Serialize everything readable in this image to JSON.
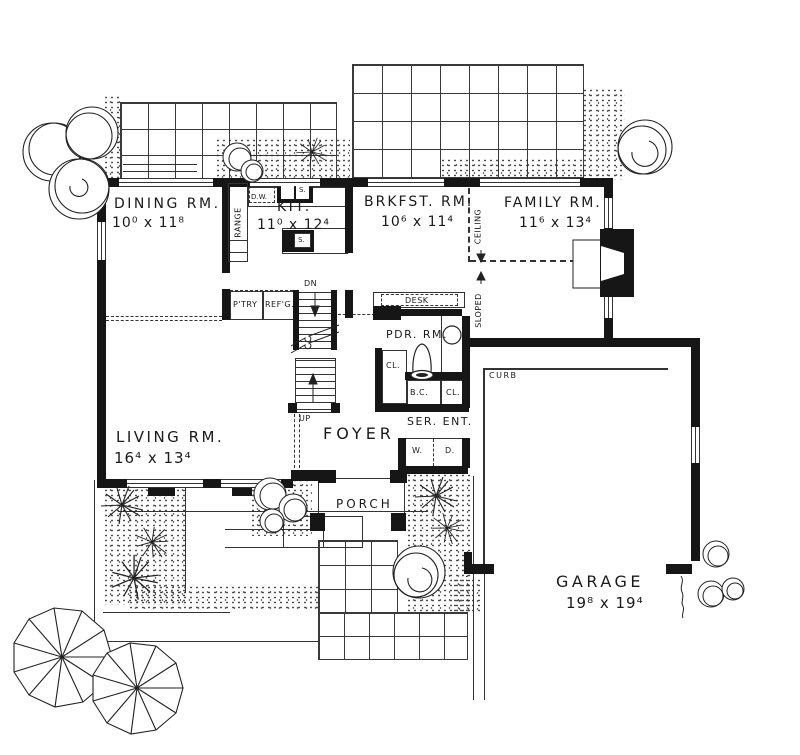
{
  "drawing": {
    "type": "house floor plan",
    "ink": "#1a1a1a",
    "paper": "#ffffff"
  },
  "rooms": {
    "dining": {
      "name": "DINING RM.",
      "dims": "10⁰ x 11⁸"
    },
    "kitchen": {
      "name": "KIT.",
      "dims": "11⁰ x 12⁴"
    },
    "breakfast": {
      "name": "BRKFST. RM.",
      "dims": "10⁶ x 11⁴"
    },
    "family": {
      "name": "FAMILY RM.",
      "dims": "11⁶ x 13⁴"
    },
    "living": {
      "name": "LIVING RM.",
      "dims": "16⁴ x 13⁴"
    },
    "foyer": {
      "name": "FOYER"
    },
    "porch": {
      "name": "PORCH"
    },
    "garage": {
      "name": "GARAGE",
      "dims": "19⁸ x 19⁴"
    },
    "powder": {
      "name": "PDR. RM."
    },
    "service_entry": {
      "name": "SER. ENT."
    }
  },
  "fixtures": {
    "dishwasher": "D.W.",
    "sink_wall": "S.",
    "sink_island": "S.",
    "range": "RANGE",
    "pantry": "P'TRY",
    "refrigerator": "REF'G.",
    "desk": "DESK",
    "washer": "W.",
    "dryer": "D.",
    "closet_hall": "CL.",
    "broom_closet": "B.C.",
    "closet_service": "CL."
  },
  "stairs": {
    "down": "DN",
    "up": "UP"
  },
  "site": {
    "curb": "CURB"
  },
  "ceiling_note": {
    "upper": "CEILING",
    "lower": "SLOPED"
  }
}
